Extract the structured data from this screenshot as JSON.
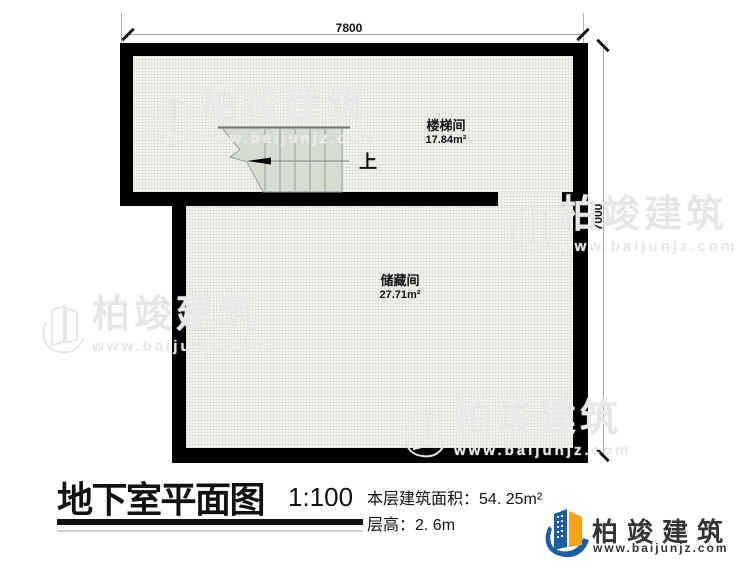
{
  "plan": {
    "dim_top": "7800",
    "dim_right": "7000",
    "rooms": {
      "stairwell": {
        "name": "楼梯间",
        "area": "17.84m²"
      },
      "storage": {
        "name": "储藏间",
        "area": "27.71m²"
      }
    },
    "stair_up_label": "上",
    "colors": {
      "wall": "#000000",
      "floor": "#f2f2ef",
      "stair_fill": "#d7dcd3",
      "dim_line": "#a8a8a8"
    }
  },
  "title_block": {
    "title": "地下室平面图",
    "scale": "1:100",
    "area_label": "本层建筑面积：",
    "area_value": "54. 25m²",
    "height_label": "层高：",
    "height_value": "2. 6m"
  },
  "brand": {
    "name": "柏竣建筑",
    "website": "www.baijunjz.com",
    "colors": {
      "blue": "#1b5ea6",
      "orange": "#f6a21d",
      "text": "#333333"
    }
  },
  "watermark": {
    "name": "柏竣建筑",
    "website": "www.baijunjz.com"
  }
}
